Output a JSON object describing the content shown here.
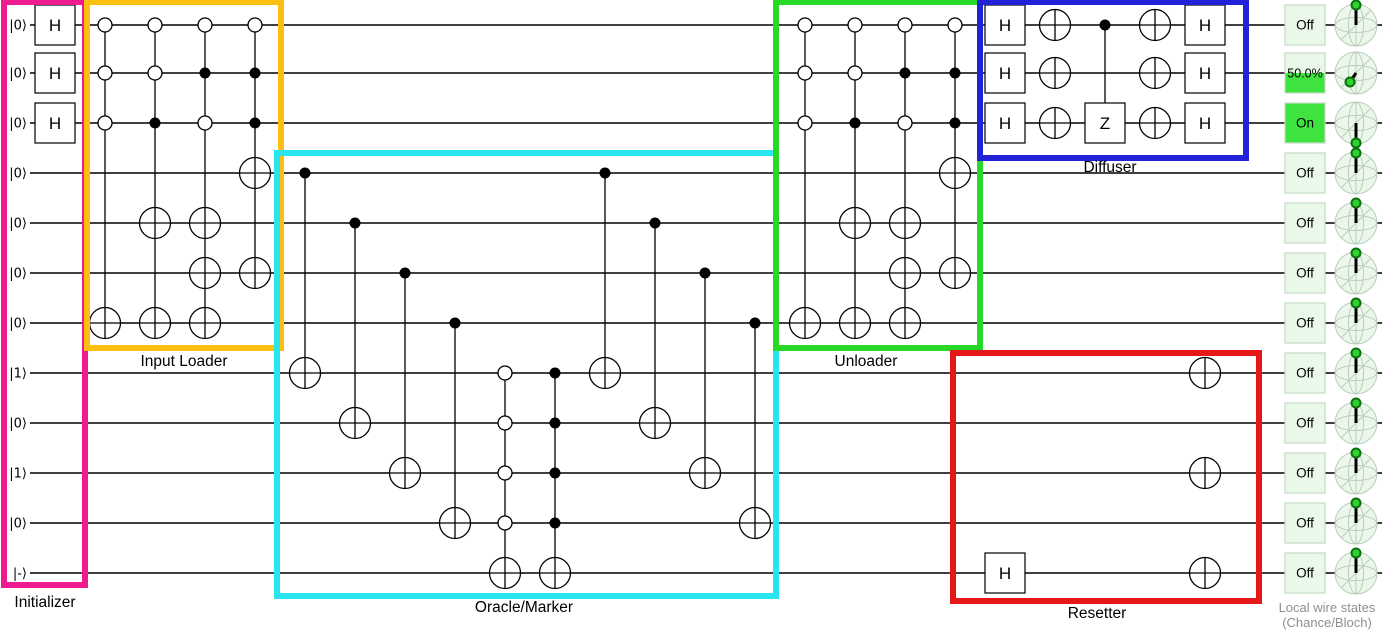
{
  "colors": {
    "wire": "#000000",
    "gate_fill": "#ffffff",
    "gate_stroke": "#000000",
    "initializer": "#ee1a90",
    "input_loader": "#fcbe11",
    "oracle": "#29e5ef",
    "unloader": "#26d926",
    "diffuser": "#2222d9",
    "resetter": "#e51818",
    "chance_bg": "#e9f8e9",
    "chance_border": "#c5d9c5",
    "chance_fill": "#3fe33f",
    "bloch_bg": "#ecf7ec",
    "bloch_line": "#b9cdb9",
    "bloch_vector": "#000000",
    "bloch_dot": "#2ed42e",
    "bloch_dot_ring": "#0e6f0e",
    "caption_text": "#8f8f8f"
  },
  "geometry": {
    "width": 1382,
    "height": 633,
    "wire_x_start": 30,
    "wire_x_end": 1382,
    "wire_ys": [
      25,
      73,
      123,
      173,
      223,
      273,
      323,
      373,
      423,
      473,
      523,
      573
    ],
    "ket_x": 27,
    "gate_size": 40,
    "target_r": 15.5,
    "dot_r": 5.5,
    "anti_r": 7,
    "chance_x": 1285,
    "chance_size": 40,
    "bloch_cx": 1356,
    "bloch_r": 21
  },
  "wires": [
    "|0⟩",
    "|0⟩",
    "|0⟩",
    "|0⟩",
    "|0⟩",
    "|0⟩",
    "|0⟩",
    "|1⟩",
    "|0⟩",
    "|1⟩",
    "|0⟩",
    "|-⟩"
  ],
  "columns": [
    {
      "x": 55,
      "items": [
        {
          "w": 0,
          "g": "H"
        },
        {
          "w": 1,
          "g": "H"
        },
        {
          "w": 2,
          "g": "H"
        }
      ]
    },
    {
      "x": 105,
      "line": [
        0,
        6
      ],
      "items": [
        {
          "w": 0,
          "g": "anti"
        },
        {
          "w": 1,
          "g": "anti"
        },
        {
          "w": 2,
          "g": "anti"
        },
        {
          "w": 6,
          "g": "target"
        }
      ]
    },
    {
      "x": 155,
      "line": [
        0,
        6
      ],
      "items": [
        {
          "w": 0,
          "g": "anti"
        },
        {
          "w": 1,
          "g": "anti"
        },
        {
          "w": 2,
          "g": "control"
        },
        {
          "w": 4,
          "g": "target"
        },
        {
          "w": 6,
          "g": "target"
        }
      ]
    },
    {
      "x": 205,
      "line": [
        0,
        6
      ],
      "items": [
        {
          "w": 0,
          "g": "anti"
        },
        {
          "w": 1,
          "g": "control"
        },
        {
          "w": 2,
          "g": "anti"
        },
        {
          "w": 4,
          "g": "target"
        },
        {
          "w": 5,
          "g": "target"
        },
        {
          "w": 6,
          "g": "target"
        }
      ]
    },
    {
      "x": 255,
      "line": [
        0,
        5
      ],
      "items": [
        {
          "w": 0,
          "g": "anti"
        },
        {
          "w": 1,
          "g": "control"
        },
        {
          "w": 2,
          "g": "control"
        },
        {
          "w": 3,
          "g": "target"
        },
        {
          "w": 5,
          "g": "target"
        }
      ]
    },
    {
      "x": 305,
      "line": [
        3,
        7
      ],
      "items": [
        {
          "w": 3,
          "g": "control"
        },
        {
          "w": 7,
          "g": "target"
        }
      ]
    },
    {
      "x": 355,
      "line": [
        4,
        8
      ],
      "items": [
        {
          "w": 4,
          "g": "control"
        },
        {
          "w": 8,
          "g": "target"
        }
      ]
    },
    {
      "x": 405,
      "line": [
        5,
        9
      ],
      "items": [
        {
          "w": 5,
          "g": "control"
        },
        {
          "w": 9,
          "g": "target"
        }
      ]
    },
    {
      "x": 455,
      "line": [
        6,
        10
      ],
      "items": [
        {
          "w": 6,
          "g": "control"
        },
        {
          "w": 10,
          "g": "target"
        }
      ]
    },
    {
      "x": 505,
      "line": [
        7,
        11
      ],
      "items": [
        {
          "w": 7,
          "g": "anti"
        },
        {
          "w": 8,
          "g": "anti"
        },
        {
          "w": 9,
          "g": "anti"
        },
        {
          "w": 10,
          "g": "anti"
        },
        {
          "w": 11,
          "g": "target"
        }
      ]
    },
    {
      "x": 555,
      "line": [
        7,
        11
      ],
      "items": [
        {
          "w": 7,
          "g": "control"
        },
        {
          "w": 8,
          "g": "control"
        },
        {
          "w": 9,
          "g": "control"
        },
        {
          "w": 10,
          "g": "control"
        },
        {
          "w": 11,
          "g": "target"
        }
      ]
    },
    {
      "x": 605,
      "line": [
        3,
        7
      ],
      "items": [
        {
          "w": 3,
          "g": "control"
        },
        {
          "w": 7,
          "g": "target"
        }
      ]
    },
    {
      "x": 655,
      "line": [
        4,
        8
      ],
      "items": [
        {
          "w": 4,
          "g": "control"
        },
        {
          "w": 8,
          "g": "target"
        }
      ]
    },
    {
      "x": 705,
      "line": [
        5,
        9
      ],
      "items": [
        {
          "w": 5,
          "g": "control"
        },
        {
          "w": 9,
          "g": "target"
        }
      ]
    },
    {
      "x": 755,
      "line": [
        6,
        10
      ],
      "items": [
        {
          "w": 6,
          "g": "control"
        },
        {
          "w": 10,
          "g": "target"
        }
      ]
    },
    {
      "x": 805,
      "line": [
        0,
        6
      ],
      "items": [
        {
          "w": 0,
          "g": "anti"
        },
        {
          "w": 1,
          "g": "anti"
        },
        {
          "w": 2,
          "g": "anti"
        },
        {
          "w": 6,
          "g": "target"
        }
      ]
    },
    {
      "x": 855,
      "line": [
        0,
        6
      ],
      "items": [
        {
          "w": 0,
          "g": "anti"
        },
        {
          "w": 1,
          "g": "anti"
        },
        {
          "w": 2,
          "g": "control"
        },
        {
          "w": 4,
          "g": "target"
        },
        {
          "w": 6,
          "g": "target"
        }
      ]
    },
    {
      "x": 905,
      "line": [
        0,
        6
      ],
      "items": [
        {
          "w": 0,
          "g": "anti"
        },
        {
          "w": 1,
          "g": "control"
        },
        {
          "w": 2,
          "g": "anti"
        },
        {
          "w": 4,
          "g": "target"
        },
        {
          "w": 5,
          "g": "target"
        },
        {
          "w": 6,
          "g": "target"
        }
      ]
    },
    {
      "x": 955,
      "line": [
        0,
        5
      ],
      "items": [
        {
          "w": 0,
          "g": "anti"
        },
        {
          "w": 1,
          "g": "control"
        },
        {
          "w": 2,
          "g": "control"
        },
        {
          "w": 3,
          "g": "target"
        },
        {
          "w": 5,
          "g": "target"
        }
      ]
    },
    {
      "x": 1005,
      "items": [
        {
          "w": 0,
          "g": "H"
        },
        {
          "w": 1,
          "g": "H"
        },
        {
          "w": 2,
          "g": "H"
        }
      ]
    },
    {
      "x": 1055,
      "items": [
        {
          "w": 0,
          "g": "target"
        },
        {
          "w": 1,
          "g": "target"
        },
        {
          "w": 2,
          "g": "target"
        }
      ]
    },
    {
      "x": 1105,
      "line": [
        0,
        2
      ],
      "items": [
        {
          "w": 0,
          "g": "control"
        },
        {
          "w": 2,
          "g": "Z"
        }
      ]
    },
    {
      "x": 1155,
      "items": [
        {
          "w": 0,
          "g": "target"
        },
        {
          "w": 1,
          "g": "target"
        },
        {
          "w": 2,
          "g": "target"
        }
      ]
    },
    {
      "x": 1205,
      "items": [
        {
          "w": 0,
          "g": "H"
        },
        {
          "w": 1,
          "g": "H"
        },
        {
          "w": 2,
          "g": "H"
        }
      ]
    },
    {
      "x": 1005,
      "items": [
        {
          "w": 11,
          "g": "H"
        }
      ]
    },
    {
      "x": 1205,
      "items": [
        {
          "w": 7,
          "g": "target"
        },
        {
          "w": 9,
          "g": "target"
        },
        {
          "w": 11,
          "g": "target"
        }
      ]
    }
  ],
  "sections": [
    {
      "label": "Initializer",
      "color_key": "initializer",
      "rect": [
        4,
        2,
        85,
        585
      ],
      "label_at": [
        45,
        607
      ]
    },
    {
      "label": "Input Loader",
      "color_key": "input_loader",
      "rect": [
        87,
        2,
        281,
        348
      ],
      "label_at": [
        184,
        366
      ]
    },
    {
      "label": "Oracle/Marker",
      "color_key": "oracle",
      "rect": [
        277,
        153,
        776,
        596
      ],
      "label_at": [
        524,
        612
      ]
    },
    {
      "label": "Unloader",
      "color_key": "unloader",
      "rect": [
        776,
        2,
        980,
        348
      ],
      "label_at": [
        866,
        366
      ]
    },
    {
      "label": "Diffuser",
      "color_key": "diffuser",
      "rect": [
        980,
        2,
        1246,
        158
      ],
      "label_at": [
        1110,
        172
      ]
    },
    {
      "label": "Resetter",
      "color_key": "resetter",
      "rect": [
        953,
        353,
        1259,
        601
      ],
      "label_at": [
        1097,
        618
      ]
    }
  ],
  "indicators": [
    {
      "chance": "Off",
      "fill_fraction": 0,
      "bloch": "up"
    },
    {
      "chance": "50.0%",
      "fill_fraction": 0.5,
      "bloch": "minus_x"
    },
    {
      "chance": "On",
      "fill_fraction": 1,
      "bloch": "down"
    },
    {
      "chance": "Off",
      "fill_fraction": 0,
      "bloch": "up"
    },
    {
      "chance": "Off",
      "fill_fraction": 0,
      "bloch": "up"
    },
    {
      "chance": "Off",
      "fill_fraction": 0,
      "bloch": "up"
    },
    {
      "chance": "Off",
      "fill_fraction": 0,
      "bloch": "up"
    },
    {
      "chance": "Off",
      "fill_fraction": 0,
      "bloch": "up"
    },
    {
      "chance": "Off",
      "fill_fraction": 0,
      "bloch": "up"
    },
    {
      "chance": "Off",
      "fill_fraction": 0,
      "bloch": "up"
    },
    {
      "chance": "Off",
      "fill_fraction": 0,
      "bloch": "up"
    },
    {
      "chance": "Off",
      "fill_fraction": 0,
      "bloch": "up"
    }
  ],
  "bloch_vectors": {
    "up": [
      0,
      -20
    ],
    "down": [
      0,
      20
    ],
    "minus_x": [
      -6,
      9
    ]
  },
  "rail": {
    "caption_line1": "Local wire states",
    "caption_line2": "(Chance/Bloch)"
  }
}
